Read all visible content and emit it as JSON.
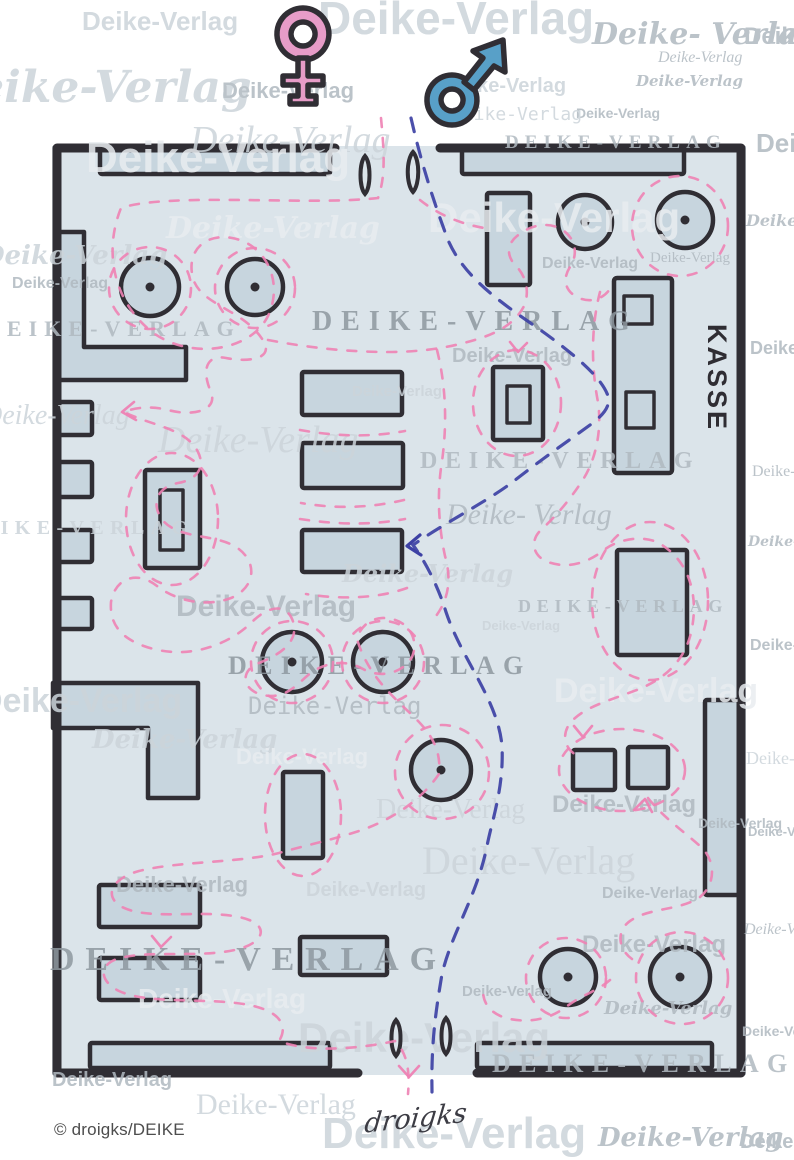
{
  "labels": {
    "kasse": "KASSE",
    "copyright": "© droigks/DEIKE",
    "signature": "droigks"
  },
  "icons": {
    "female_symbol": "♀",
    "male_symbol": "♂"
  },
  "colors": {
    "paper": "#ffffff",
    "interior": "#dbe4ea",
    "fixture_fill": "#c7d5de",
    "outline": "#302e34",
    "path_female_pink": "#ee82b4",
    "path_male_blue": "#3d41a4",
    "symbol_female_pink": "#e79cc8",
    "symbol_male_blue": "#58a0c8",
    "kasse_text": "#2f2d33",
    "copyright_text": "#4d4d4d",
    "signature_ink": "#3c3c44",
    "wm_dark": "#8e98a0",
    "wm_mid": "#b0b9c0",
    "wm_light": "#ccd4da",
    "wm_white": "#e9edf0"
  },
  "watermarks": {
    "variants": {
      "plain": "Deike-Verlag",
      "caps": "DEIKE-VERLAG",
      "spaced": "Deike- Verlag"
    },
    "instances": [
      [
        82,
        30,
        26,
        "b",
        "light",
        "plain"
      ],
      [
        318,
        34,
        46,
        "b",
        "light",
        "plain"
      ],
      [
        592,
        44,
        30,
        "s",
        "mid",
        "spaced"
      ],
      [
        744,
        44,
        24,
        "b",
        "mid",
        "plain"
      ],
      [
        -62,
        102,
        44,
        "s",
        "light",
        "plain"
      ],
      [
        222,
        98,
        22,
        "b",
        "mid",
        "plain"
      ],
      [
        190,
        152,
        38,
        "i",
        "light",
        "plain"
      ],
      [
        446,
        92,
        20,
        "b",
        "light",
        "plain"
      ],
      [
        636,
        86,
        15,
        "s",
        "mid",
        "plain"
      ],
      [
        505,
        148,
        19,
        "c",
        "mid",
        "caps"
      ],
      [
        576,
        118,
        14,
        "b",
        "mid",
        "plain"
      ],
      [
        756,
        152,
        26,
        "b",
        "mid",
        "plain"
      ],
      [
        86,
        172,
        44,
        "b",
        "white",
        "plain"
      ],
      [
        452,
        120,
        18,
        "m",
        "light",
        "plain"
      ],
      [
        658,
        62,
        16,
        "i",
        "mid",
        "plain"
      ],
      [
        166,
        238,
        30,
        "s",
        "white",
        "plain"
      ],
      [
        -18,
        264,
        26,
        "s",
        "light",
        "plain"
      ],
      [
        12,
        288,
        16,
        "b",
        "mid",
        "plain"
      ],
      [
        428,
        232,
        42,
        "b",
        "white",
        "plain"
      ],
      [
        650,
        262,
        15,
        "r",
        "mid",
        "plain"
      ],
      [
        542,
        268,
        16,
        "b",
        "mid",
        "plain"
      ],
      [
        312,
        330,
        28,
        "c",
        "dark",
        "caps"
      ],
      [
        452,
        362,
        20,
        "b",
        "mid",
        "plain"
      ],
      [
        352,
        396,
        15,
        "b",
        "light",
        "plain"
      ],
      [
        -16,
        336,
        22,
        "c",
        "mid",
        "caps"
      ],
      [
        158,
        452,
        38,
        "i",
        "light",
        "plain"
      ],
      [
        420,
        468,
        24,
        "c",
        "mid",
        "caps"
      ],
      [
        446,
        524,
        30,
        "i",
        "mid",
        "spaced"
      ],
      [
        -18,
        424,
        28,
        "i",
        "light",
        "plain"
      ],
      [
        -40,
        534,
        20,
        "c",
        "light",
        "caps"
      ],
      [
        342,
        582,
        24,
        "s",
        "light",
        "plain"
      ],
      [
        176,
        616,
        30,
        "b",
        "mid",
        "plain"
      ],
      [
        518,
        612,
        18,
        "c",
        "mid",
        "caps"
      ],
      [
        482,
        630,
        13,
        "b",
        "light",
        "plain"
      ],
      [
        228,
        674,
        26,
        "c",
        "dark",
        "caps"
      ],
      [
        554,
        702,
        34,
        "b",
        "white",
        "plain"
      ],
      [
        248,
        714,
        24,
        "m",
        "mid",
        "plain"
      ],
      [
        -22,
        712,
        34,
        "b",
        "light",
        "plain"
      ],
      [
        92,
        748,
        26,
        "s",
        "light",
        "plain"
      ],
      [
        236,
        764,
        22,
        "b",
        "white",
        "plain"
      ],
      [
        376,
        818,
        28,
        "r",
        "light",
        "plain"
      ],
      [
        422,
        874,
        40,
        "r",
        "light",
        "plain"
      ],
      [
        552,
        812,
        24,
        "b",
        "mid",
        "plain"
      ],
      [
        698,
        828,
        14,
        "b",
        "mid",
        "plain"
      ],
      [
        116,
        892,
        22,
        "b",
        "mid",
        "plain"
      ],
      [
        306,
        896,
        20,
        "b",
        "light",
        "plain"
      ],
      [
        602,
        898,
        16,
        "b",
        "mid",
        "plain"
      ],
      [
        50,
        970,
        34,
        "c",
        "dark",
        "caps"
      ],
      [
        138,
        1008,
        28,
        "b",
        "white",
        "plain"
      ],
      [
        582,
        952,
        24,
        "b",
        "mid",
        "plain"
      ],
      [
        462,
        996,
        15,
        "b",
        "mid",
        "plain"
      ],
      [
        604,
        1014,
        18,
        "s",
        "mid",
        "plain"
      ],
      [
        298,
        1052,
        42,
        "b",
        "light",
        "plain"
      ],
      [
        492,
        1072,
        26,
        "c",
        "mid",
        "caps"
      ],
      [
        52,
        1086,
        20,
        "b",
        "mid",
        "plain"
      ],
      [
        196,
        1114,
        30,
        "r",
        "light",
        "plain"
      ],
      [
        322,
        1148,
        44,
        "b",
        "light",
        "plain"
      ],
      [
        598,
        1146,
        26,
        "s",
        "mid",
        "plain"
      ],
      [
        740,
        1148,
        20,
        "b",
        "mid",
        "plain"
      ],
      [
        746,
        226,
        16,
        "s",
        "mid",
        "plain"
      ],
      [
        750,
        354,
        18,
        "b",
        "mid",
        "plain"
      ],
      [
        752,
        476,
        16,
        "r",
        "mid",
        "plain"
      ],
      [
        748,
        546,
        14,
        "s",
        "mid",
        "plain"
      ],
      [
        750,
        650,
        16,
        "b",
        "mid",
        "plain"
      ],
      [
        746,
        764,
        18,
        "r",
        "light",
        "plain"
      ],
      [
        748,
        836,
        13,
        "b",
        "mid",
        "plain"
      ],
      [
        744,
        934,
        16,
        "i",
        "mid",
        "plain"
      ],
      [
        742,
        1036,
        14,
        "b",
        "mid",
        "plain"
      ]
    ]
  }
}
